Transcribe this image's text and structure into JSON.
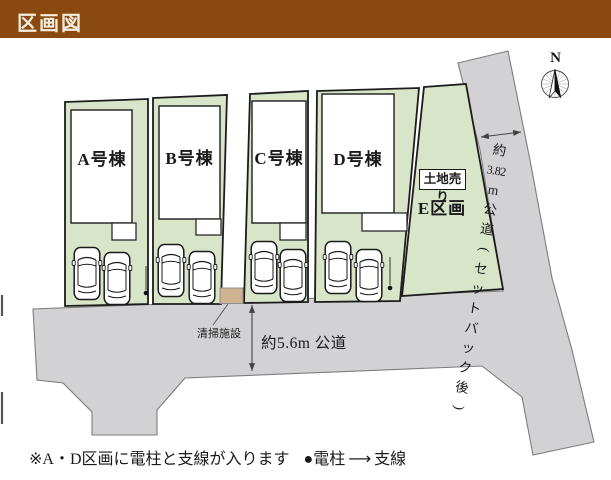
{
  "header": {
    "title": "区画図"
  },
  "map": {
    "lots": [
      {
        "id": "A",
        "label": "A号棟"
      },
      {
        "id": "B",
        "label": "B号棟"
      },
      {
        "id": "C",
        "label": "C号棟"
      },
      {
        "id": "D",
        "label": "D号棟"
      }
    ],
    "lot_e": {
      "sale_badge": "土地売り",
      "label": "E区画"
    },
    "south_road_label": "約5.6m 公道",
    "east_road_label": "約3.82m 公道(セットバック後)",
    "east_road_label_chars": [
      "約",
      "3.82",
      "m",
      "公",
      "道",
      "(",
      "セ",
      "ッ",
      "ト",
      "バ",
      "ッ",
      "ク",
      "後",
      ")"
    ],
    "cleaning_facility_label": "清掃施設",
    "compass_label": "N"
  },
  "footer": {
    "note": "※A・D区画に電柱と支線が入ります",
    "legend_pole_bullet": "●",
    "legend_pole": "電柱",
    "legend_arrow": "⟶",
    "legend_wire": "支線"
  },
  "colors": {
    "header_bg": "#8a4a0f",
    "lot_green": "#d8e5c9",
    "road_gray": "#d2d2d4",
    "facility_tan": "#cfb390"
  }
}
